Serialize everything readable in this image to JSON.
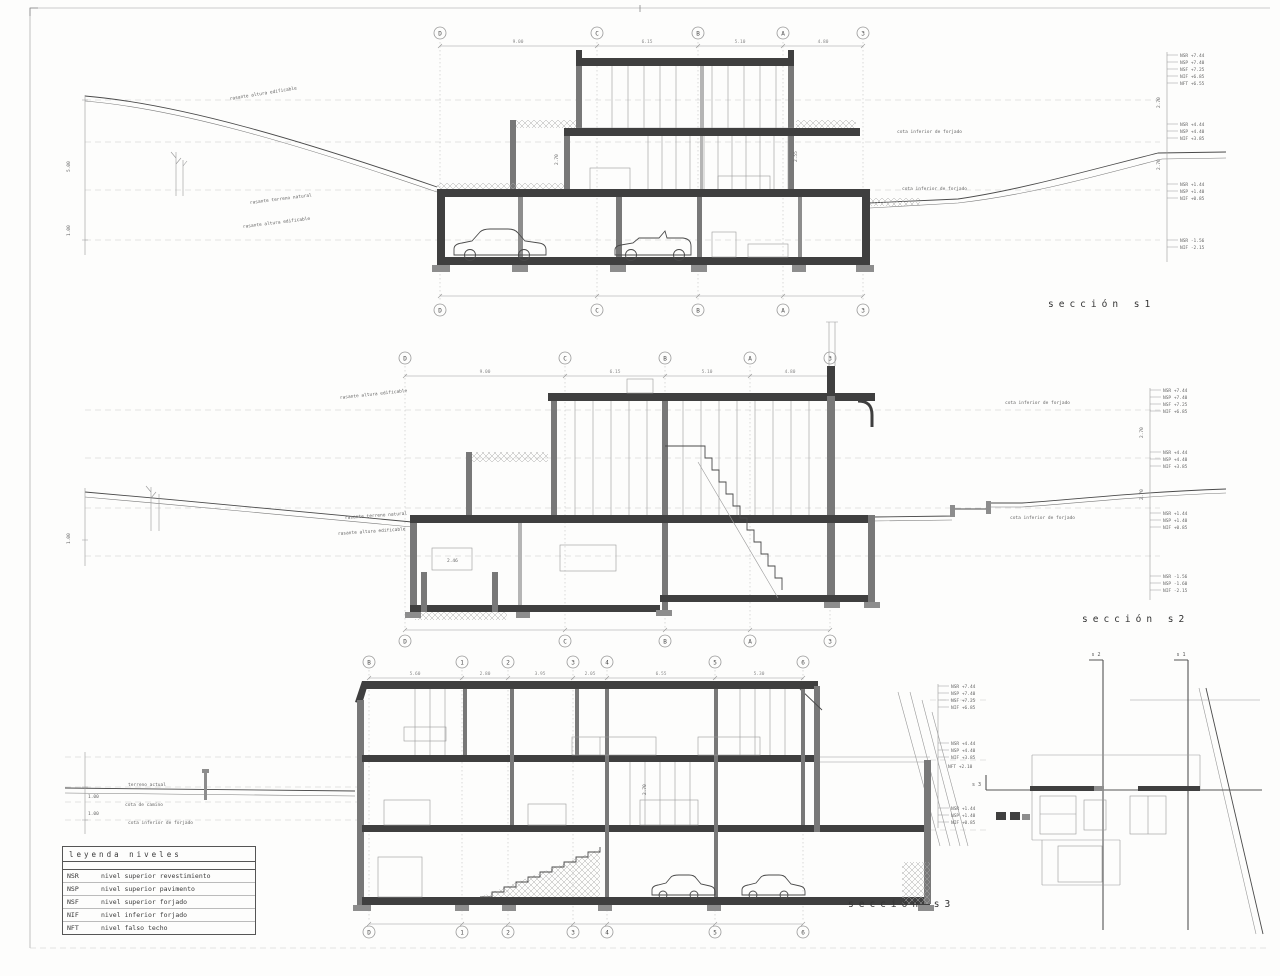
{
  "sheet": {
    "background": "#fdfdfc",
    "ink": "#3f3f3f",
    "light_line": "#9a9a9a"
  },
  "titles": {
    "s1": "sección s1",
    "s2": "sección s2",
    "s3": "sección s3"
  },
  "legend": {
    "title": "leyenda niveles",
    "rows": [
      {
        "abbr": "NSR",
        "label": "nivel superior revestimiento"
      },
      {
        "abbr": "NSP",
        "label": "nivel superior pavimento"
      },
      {
        "abbr": "NSF",
        "label": "nivel superior forjado"
      },
      {
        "abbr": "NIF",
        "label": "nivel inferior forjado"
      },
      {
        "abbr": "NFT",
        "label": "nivel falso techo"
      }
    ]
  },
  "grids": {
    "s1_top": [
      "D",
      "C",
      "B",
      "A",
      "3"
    ],
    "s1_bottom": [
      "D",
      "C",
      "B",
      "A",
      "3"
    ],
    "s2_top": [
      "D",
      "C",
      "B",
      "A",
      "3"
    ],
    "s2_bottom": [
      "D",
      "C",
      "B",
      "A",
      "3"
    ],
    "s3_top": [
      "B",
      "1",
      "2",
      "3",
      "4",
      "5",
      "6"
    ],
    "s3_bottom": [
      "D",
      "1",
      "2",
      "3",
      "4",
      "5",
      "6"
    ]
  },
  "dims": {
    "s1": [
      "9.00",
      "6.15",
      "5.10",
      "4.80"
    ],
    "s2": [
      "9.00",
      "6.15",
      "5.10",
      "4.80"
    ],
    "s3": [
      "5.60",
      "2.80",
      "3.95",
      "2.05",
      "6.55",
      "5.30"
    ]
  },
  "levels": {
    "s1a": [
      "NSR +7.44",
      "NSP +7.40",
      "NSF +7.25",
      "NIF +6.85",
      "NFT +6.55"
    ],
    "s1b": [
      "NSR +4.44",
      "NSP +4.40",
      "NIF +3.85"
    ],
    "s1c": [
      "NSR +1.44",
      "NSP +1.40",
      "NIF +0.85"
    ],
    "s1d": [
      "NSR -1.56",
      "NIF -2.15"
    ],
    "s2a": [
      "NSR +7.44",
      "NSP +7.40",
      "NSF +7.25",
      "NIF +6.85"
    ],
    "s2b": [
      "NSR +4.44",
      "NSP +4.40",
      "NIF +3.85"
    ],
    "s2c": [
      "NSR +1.44",
      "NSP +1.40",
      "NIF +0.85"
    ],
    "s2d": [
      "NSR -1.56",
      "NSP -1.60",
      "NIF -2.15"
    ],
    "s3a": [
      "NSR +7.44",
      "NSP +7.40",
      "NSF +7.25",
      "NIF +6.85"
    ],
    "s3b": [
      "NSR +4.44",
      "NSP +4.40",
      "NIF +3.85"
    ],
    "s3c": [
      "NSR +1.44",
      "NSP +1.40",
      "NIF +0.85"
    ]
  },
  "heights": {
    "floor": "2.70",
    "room": "2.55",
    "lower": "2.46",
    "h1": "5.00",
    "h2": "1.00"
  },
  "annotations": {
    "rasante": "rasante altura edificable",
    "terreno": "rasante terreno natural",
    "cota_forjado": "cota inferior de forjado",
    "terreno_actual": "terreno actual",
    "cota_camino": "cota de camino",
    "plan_note": "NFT +2.10"
  },
  "key_plan": {
    "s1": "s 1",
    "s2": "s 2",
    "s3": "s 3"
  }
}
